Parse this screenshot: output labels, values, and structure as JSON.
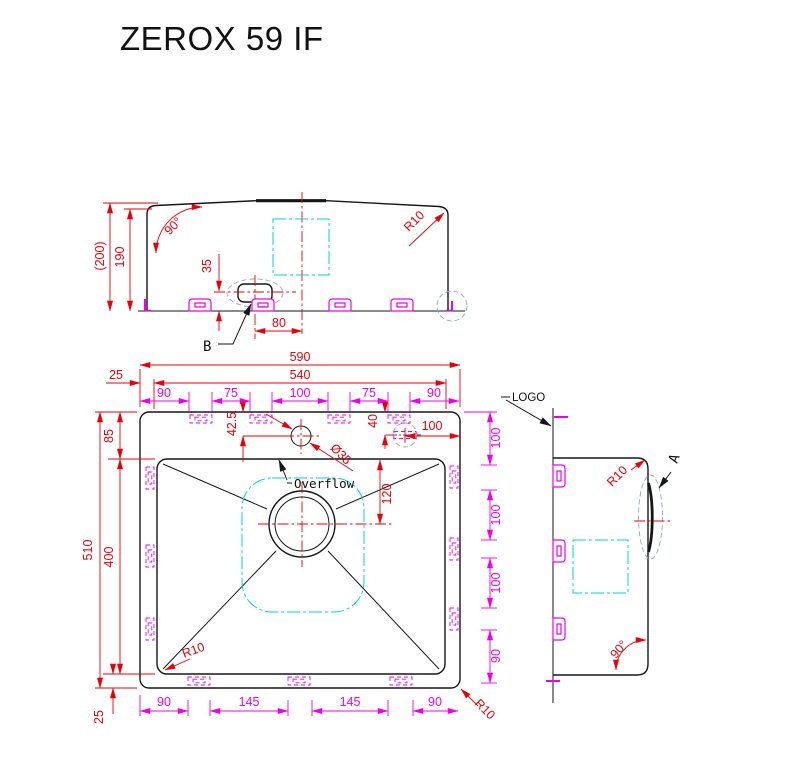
{
  "title": "ZEROX 59 IF",
  "colors": {
    "dimension_red": "#e8000a",
    "clip_magenta": "#ee00ee",
    "logo_cyan": "#00d5d5",
    "detail_blue": "#90a8cc",
    "line_black": "#161616"
  },
  "front_view": {
    "overall_height": "(200)",
    "rim_height": "190",
    "wall_angle": "90°",
    "overflow_height": "35",
    "overflow_offset": "80",
    "corner_radius": "R10",
    "detail_label": "B"
  },
  "plan_view": {
    "overall_width": "590",
    "inner_width": "540",
    "edge_offset_top": "25",
    "top_chain": [
      "90",
      "75",
      "100",
      "75",
      "90"
    ],
    "overall_depth": "510",
    "rear_ledge": "85",
    "bowl_depth": "400",
    "edge_offset_bottom": "25",
    "faucet_offset": "42.5",
    "faucet_hole_dia": "Ø35",
    "knockout_offset": "40",
    "knockout_inset": "100",
    "overflow_label": "Overflow",
    "drain_offset": "120",
    "right_chain": [
      "100",
      "100",
      "100",
      "90"
    ],
    "bottom_chain": [
      "90",
      "145",
      "145",
      "90"
    ],
    "bowl_corner_radius": "R10",
    "outer_corner_radius": "R10"
  },
  "side_view": {
    "logo_label": "LOGO",
    "overflow_detail_label": "A",
    "corner_radius": "R10",
    "wall_angle": "90°"
  }
}
